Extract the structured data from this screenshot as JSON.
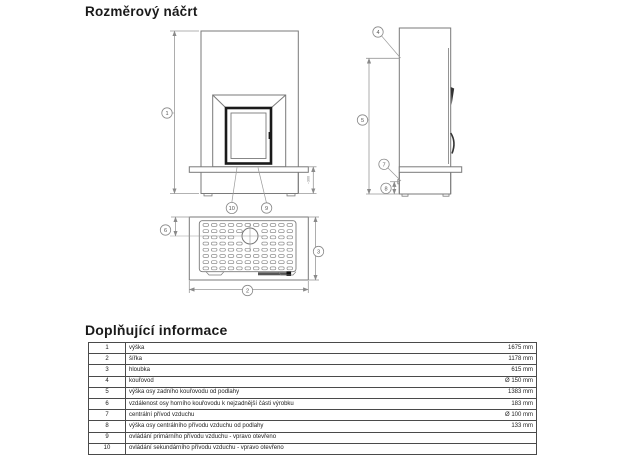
{
  "titles": {
    "drawing": "Rozměrový náčrt",
    "info": "Doplňující informace"
  },
  "diagram": {
    "views": [
      "front-elevation",
      "side-elevation",
      "top-view"
    ],
    "callouts": {
      "c1": "1",
      "c2": "2",
      "c3": "3",
      "c4": "4",
      "c5": "5",
      "c6": "6",
      "c7": "7",
      "c8": "8",
      "c9": "9",
      "c10": "10"
    },
    "small_dimension": "~300"
  },
  "table": {
    "rows": [
      {
        "num": "1",
        "label": "výška",
        "value": "1675 mm"
      },
      {
        "num": "2",
        "label": "šířka",
        "value": "1178 mm"
      },
      {
        "num": "3",
        "label": "hloubka",
        "value": "615 mm"
      },
      {
        "num": "4",
        "label": "kouřovod",
        "value": "Ø 150 mm"
      },
      {
        "num": "5",
        "label": "výška osy zadního kouřovodu od podlahy",
        "value": "1383 mm"
      },
      {
        "num": "6",
        "label": "vzdálenost osy horního kouřovodu k nejzadnější části výrobku",
        "value": "183 mm"
      },
      {
        "num": "7",
        "label": "centrální přívod vzduchu",
        "value": "Ø 100 mm"
      },
      {
        "num": "8",
        "label": "výška osy centrálního přívodu vzduchu od podlahy",
        "value": "133 mm"
      },
      {
        "num": "9",
        "label": "ovládání primárního přívodu vzduchu - vpravo otevřeno",
        "value": ""
      },
      {
        "num": "10",
        "label": "ovládání sekundárního přívodu vzduchu - vpravo otevřeno",
        "value": ""
      }
    ]
  },
  "colors": {
    "background": "#ffffff",
    "outline": "#7a7a7a",
    "dimension": "#999999",
    "door_frame": "#1a1a1a",
    "table_border": "#4a4a4a",
    "text": "#1a1a1a"
  }
}
